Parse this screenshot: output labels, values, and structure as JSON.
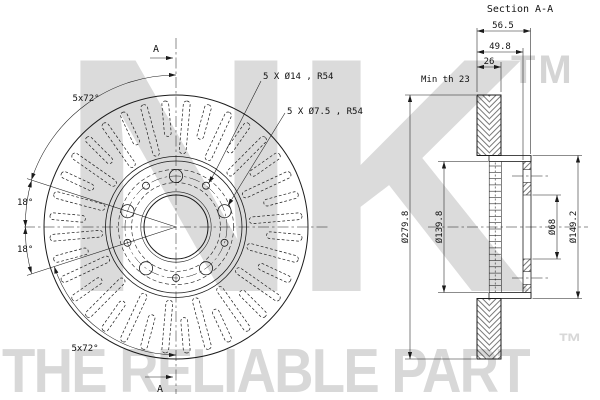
{
  "watermark": {
    "logo": "NK",
    "tm": "TM",
    "tagline": "THE RELIABLE PART",
    "tagline_tm": "™"
  },
  "section_view": {
    "title": "Section A-A",
    "dim_total_width": "56.5",
    "dim_hat_depth": "49.8",
    "dim_disc_thickness": "26",
    "dim_min_thickness": "Min th 23",
    "dim_outer_diameter": "Ø279.8",
    "dim_inner_diameter": "Ø139.8",
    "dim_bore_diameter": "Ø68",
    "dim_hat_diameter": "Ø149.2"
  },
  "front_view": {
    "label_bolt_holes": "5 X Ø14 , R54",
    "label_small_holes": "5 X Ø7.5 , R54",
    "label_pattern_top": "5x72°",
    "label_pattern_bottom": "5x72°",
    "label_angle_upper": "18°",
    "label_angle_lower": "18°",
    "section_marker_top": "A",
    "section_marker_bottom": "A"
  }
}
